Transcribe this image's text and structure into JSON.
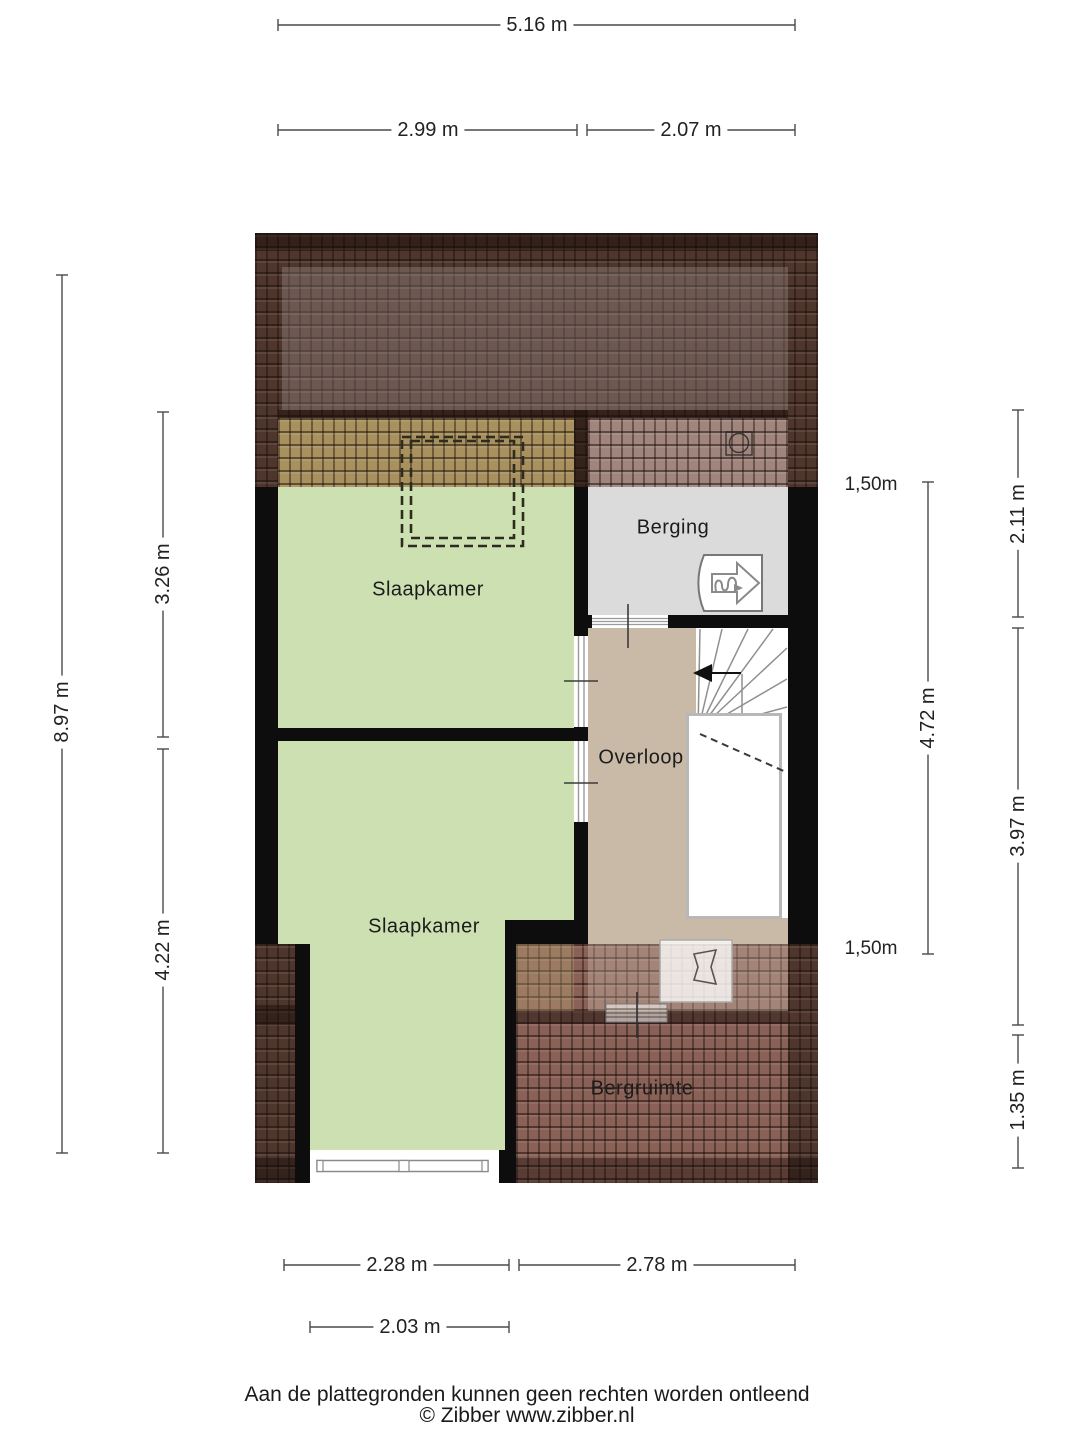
{
  "floorplan": {
    "rooms": [
      {
        "name": "slaapkamer-1",
        "label": "Slaapkamer"
      },
      {
        "name": "berging",
        "label": "Berging"
      },
      {
        "name": "overloop",
        "label": "Overloop"
      },
      {
        "name": "slaapkamer-2",
        "label": "Slaapkamer"
      },
      {
        "name": "bergruimte",
        "label": "Bergruimte"
      }
    ],
    "height_markers": [
      {
        "name": "height-marker-top",
        "label": "1,50m"
      },
      {
        "name": "height-marker-bottom",
        "label": "1,50m"
      }
    ],
    "icons": [
      {
        "name": "entrance-arrow-icon",
        "meaning": "entrance / viewing direction"
      },
      {
        "name": "skylight-icon",
        "meaning": "roof vent / skylight"
      },
      {
        "name": "stairs-direction-arrow",
        "meaning": "stair direction up"
      },
      {
        "name": "dormer-dashed-outline",
        "meaning": "dashed headroom outline"
      }
    ]
  },
  "dimensions": {
    "top": [
      {
        "label": "5.16 m"
      },
      {
        "label": "2.99 m"
      },
      {
        "label": "2.07 m"
      }
    ],
    "left": [
      {
        "label": "8.97 m"
      },
      {
        "label": "3.26 m"
      },
      {
        "label": "4.22 m"
      }
    ],
    "right": [
      {
        "label": "2.11 m"
      },
      {
        "label": "4.72 m"
      },
      {
        "label": "3.97 m"
      },
      {
        "label": "1.35 m"
      }
    ],
    "bottom": [
      {
        "label": "2.28 m"
      },
      {
        "label": "2.78 m"
      },
      {
        "label": "2.03 m"
      }
    ]
  },
  "footer": {
    "disclaimer": "Aan de plattegronden kunnen geen rechten worden ontleend",
    "copyright": "© Zibber www.zibber.nl"
  },
  "colors": {
    "wall": "#0d0d0d",
    "bedroom_green": "#cde0b2",
    "storage_gray": "#dbdbdb",
    "landing_tan": "#c8baa7",
    "roof_dark_brown": "#4e362d",
    "roof_light_brown": "#8a6156",
    "roof_olive_blend": "#a8915f",
    "roof_mauve_blend": "#a0857c"
  }
}
